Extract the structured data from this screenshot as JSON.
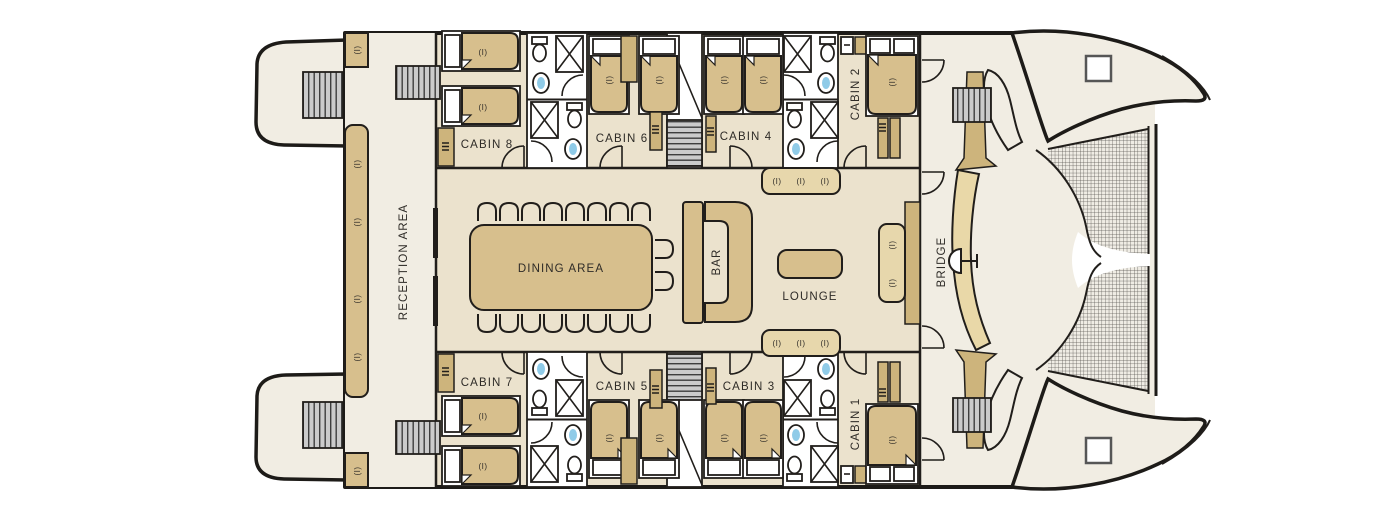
{
  "ui": {
    "marker": "(I)"
  },
  "areas": {
    "reception": "RECEPTION AREA",
    "dining": "DINING AREA",
    "bar": "BAR",
    "lounge": "LOUNGE",
    "bridge": "BRIDGE"
  },
  "cabins": {
    "c1": "CABIN 1",
    "c2": "CABIN 2",
    "c3": "CABIN 3",
    "c4": "CABIN 4",
    "c5": "CABIN 5",
    "c6": "CABIN 6",
    "c7": "CABIN 7",
    "c8": "CABIN 8"
  },
  "colors": {
    "hull": "#f1ede3",
    "interior_floor": "#ebe2cd",
    "furniture_tan": "#d7bf8d",
    "furniture_light": "#e7d7ac",
    "accent_tan": "#cdb47c",
    "outline": "#211e1b",
    "stairs_gray": "#cbcbcb",
    "sink_blue": "#8fcbe8"
  }
}
